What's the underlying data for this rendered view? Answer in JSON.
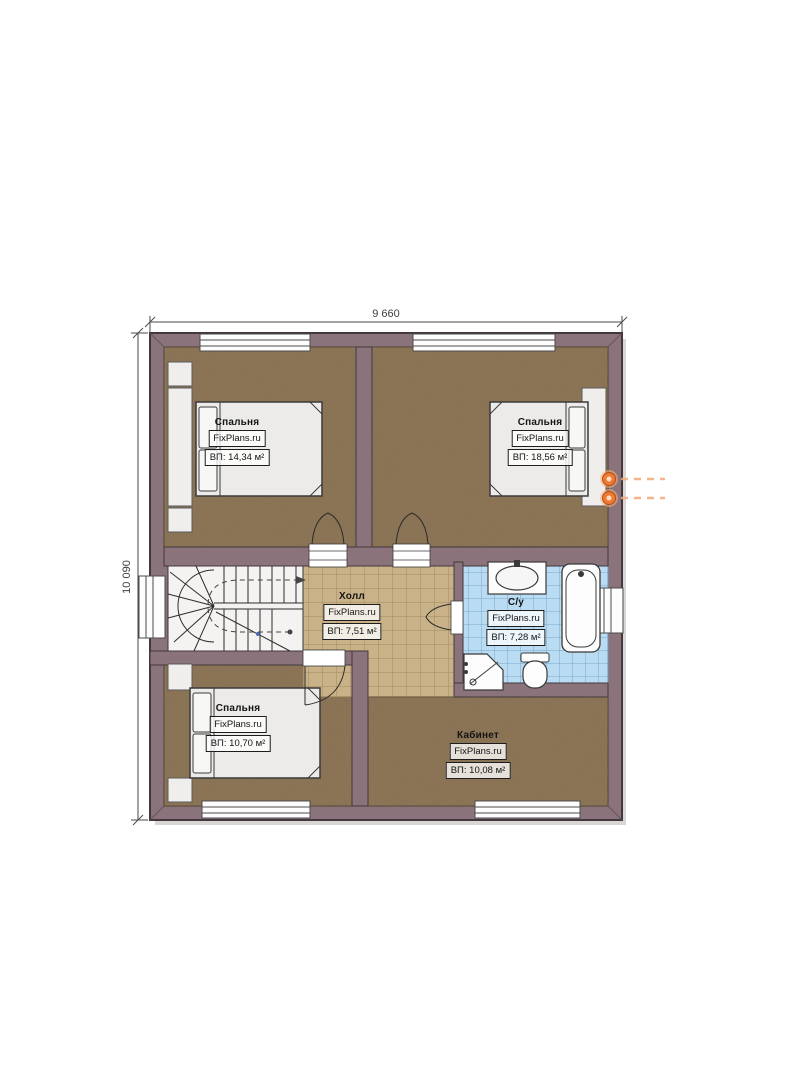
{
  "plan": {
    "width_label": "9 660",
    "height_label": "10 090",
    "watermark": "FixPlans.ru",
    "rooms": [
      {
        "key": "bedroom-top-left",
        "name": "Спальня",
        "area": "ВП: 14,34 м²"
      },
      {
        "key": "bedroom-top-right",
        "name": "Спальня",
        "area": "ВП: 18,56 м²"
      },
      {
        "key": "hall",
        "name": "Холл",
        "area": "ВП: 7,51 м²"
      },
      {
        "key": "bathroom",
        "name": "С/у",
        "area": "ВП: 7,28 м²"
      },
      {
        "key": "bedroom-bottom-left",
        "name": "Спальня",
        "area": "ВП: 10,70 м²"
      },
      {
        "key": "office",
        "name": "Кабинет",
        "area": "ВП: 10,08 м²"
      }
    ],
    "colors": {
      "wall": "#8a737a",
      "wood_floor": "#8a7254",
      "hall_tile": "#c9b287",
      "bath_tile": "#badcf2",
      "lamp_accent": "#ef7a34"
    }
  }
}
